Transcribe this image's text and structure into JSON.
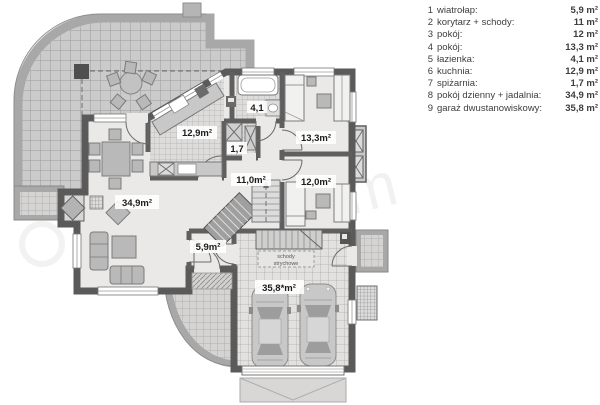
{
  "legend": {
    "items": [
      {
        "num": "1",
        "label": "wiatrołap:",
        "value": "5,9 m²"
      },
      {
        "num": "2",
        "label": "korytarz + schody:",
        "value": "11 m²"
      },
      {
        "num": "3",
        "label": "pokój:",
        "value": "12 m²"
      },
      {
        "num": "4",
        "label": "pokój:",
        "value": "13,3 m²"
      },
      {
        "num": "5",
        "label": "łazienka:",
        "value": "4,1 m²"
      },
      {
        "num": "6",
        "label": "kuchnia:",
        "value": "12,9 m²"
      },
      {
        "num": "7",
        "label": "spiżarnia:",
        "value": "1,7 m²"
      },
      {
        "num": "8",
        "label": "pokój dzienny + jadalnia:",
        "value": "34,9 m²"
      },
      {
        "num": "9",
        "label": "garaż dwustanowiskowy:",
        "value": "35,8 m²"
      }
    ]
  },
  "plan": {
    "rooms": {
      "kitchen": {
        "label": "12,9m²"
      },
      "bathroom": {
        "label": "4,1"
      },
      "pantry": {
        "label": "1,7"
      },
      "bedroom_top": {
        "label": "13,3m²"
      },
      "hallway": {
        "label": "11,0m²"
      },
      "bedroom_bottom": {
        "label": "12,0m²"
      },
      "living_room": {
        "label": "34,9m²"
      },
      "vestibule": {
        "label": "5,9m²"
      },
      "garage": {
        "label": "35,8*m²"
      }
    },
    "annotations": {
      "attic_stairs_line1": "schody",
      "attic_stairs_line2": "strychowe"
    },
    "watermark": "extradom",
    "colors": {
      "wall": "#5a5a5a",
      "floor": "#eae9e7",
      "terrace_band": "#a8a8a8",
      "legend_text": "#3d3d3d"
    }
  }
}
